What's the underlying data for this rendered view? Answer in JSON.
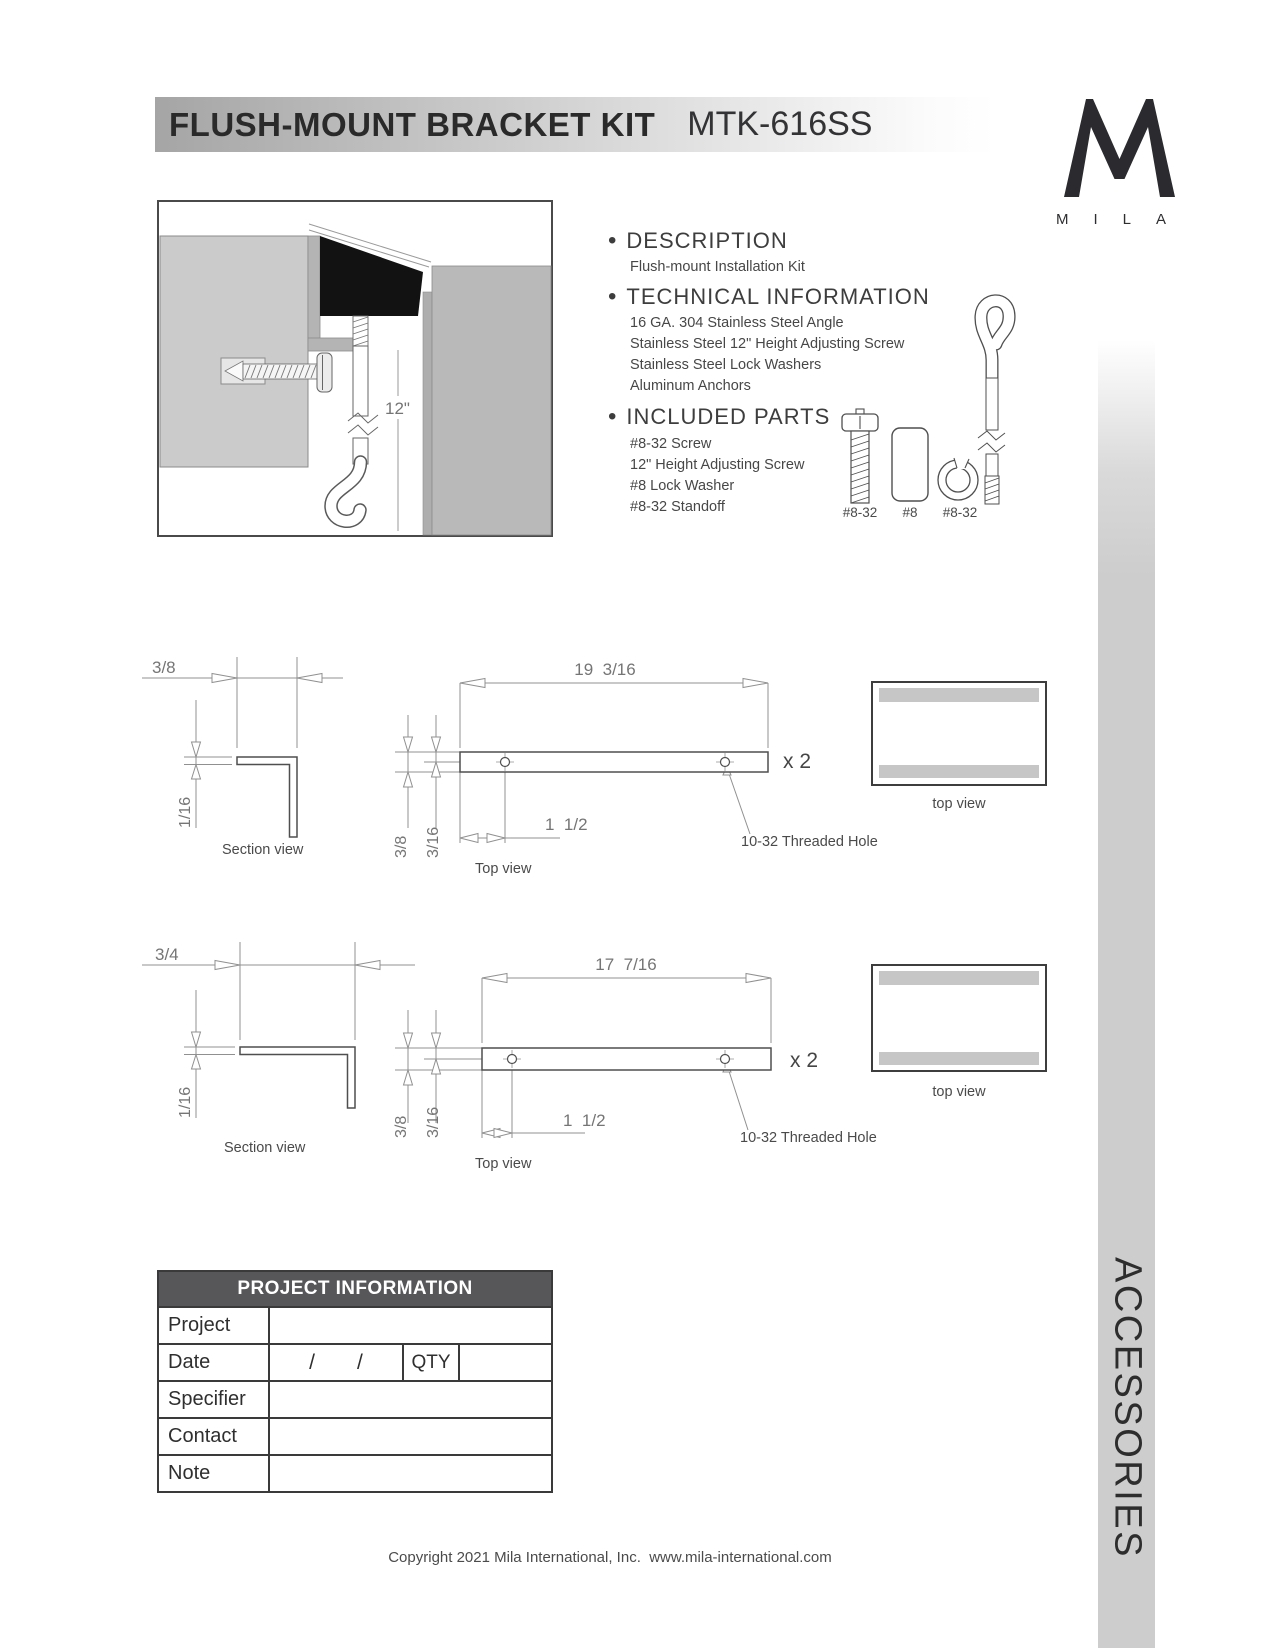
{
  "header": {
    "title": "FLUSH-MOUNT BRACKET KIT",
    "model": "MTK-616SS"
  },
  "logo": {
    "letters": "MILA"
  },
  "installation_diagram": {
    "height_dim": "12\""
  },
  "description": {
    "heading": "DESCRIPTION",
    "body": "Flush-mount Installation Kit"
  },
  "technical": {
    "heading": "TECHNICAL INFORMATION",
    "lines": [
      "16 GA. 304 Stainless Steel Angle",
      "Stainless Steel 12\" Height Adjusting Screw",
      "Stainless Steel Lock Washers",
      "Aluminum Anchors"
    ]
  },
  "included": {
    "heading": "INCLUDED PARTS",
    "lines": [
      "#8-32 Screw",
      "12\" Height Adjusting Screw",
      "#8 Lock Washer",
      "#8-32 Standoff"
    ]
  },
  "parts": {
    "labels": [
      "#8-32",
      "#8",
      "#8-32"
    ]
  },
  "drawing1": {
    "width_dim": "3/8",
    "thickness_dim": "1/16",
    "length_dim": "19  3/16",
    "qty": "x 2",
    "depth_dim": "3/8",
    "hole_center_dim": "3/16",
    "hole_offset_dim": "1  1/2",
    "hole_callout": "10-32 Threaded Hole",
    "section_view_label": "Section view",
    "top_view_label": "Top view",
    "box_label": "top view"
  },
  "drawing2": {
    "width_dim": "3/4",
    "thickness_dim": "1/16",
    "length_dim": "17  7/16",
    "qty": "x 2",
    "depth_dim": "3/8",
    "hole_center_dim": "3/16",
    "hole_offset_dim": "1  1/2",
    "hole_callout": "10-32 Threaded Hole",
    "section_view_label": "Section view",
    "top_view_label": "Top view",
    "box_label": "top view"
  },
  "project_table": {
    "title": "PROJECT INFORMATION",
    "row_labels": [
      "Project",
      "Date",
      "Specifier",
      "Contact",
      "Note"
    ],
    "slash": "/",
    "qty_label": "QTY"
  },
  "footer": {
    "copyright": "Copyright 2021 Mila International, Inc.  www.mila-international.com"
  },
  "sidebar": {
    "label": "ACCESSORIES"
  }
}
